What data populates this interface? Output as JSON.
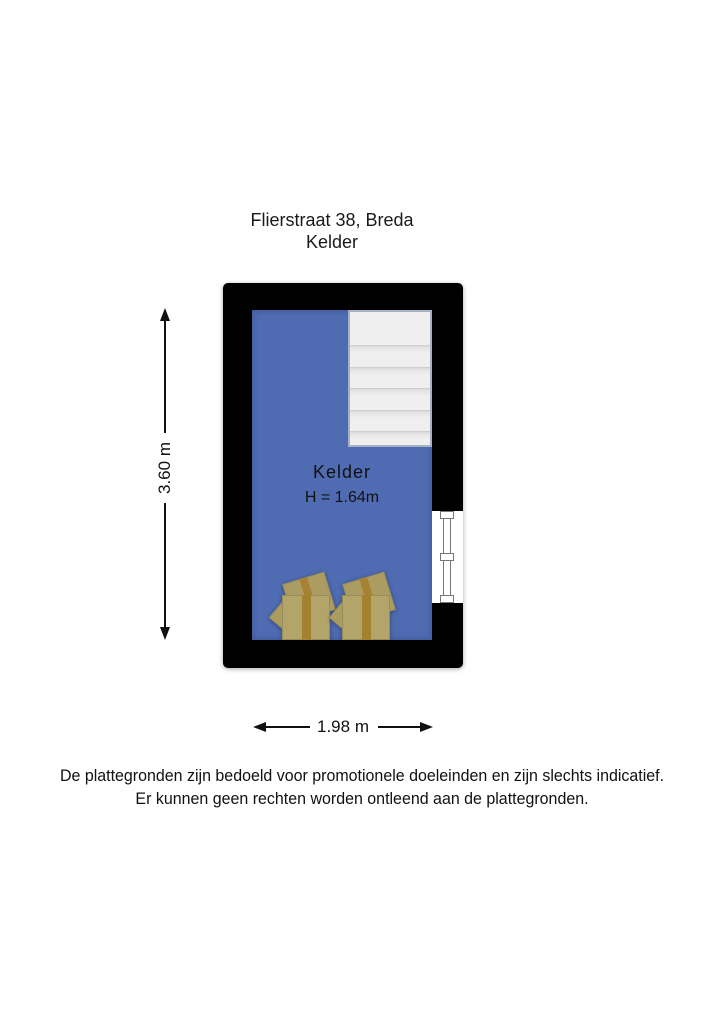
{
  "title": {
    "address": "Flierstraat 38, Breda",
    "floor": "Kelder"
  },
  "room": {
    "name": "Kelder",
    "height_label": "H = 1.64m"
  },
  "dimensions": {
    "height": "3.60 m",
    "width": "1.98 m"
  },
  "disclaimer": {
    "line1": "De plattegronden zijn bedoeld voor promotionele doeleinden en zijn slechts indicatief.",
    "line2": "Er kunnen geen rechten worden ontleend aan de plattegronden."
  },
  "plan": {
    "stair_tread_count": 6,
    "box_count": 2,
    "window_count": 1
  },
  "colors": {
    "floor": "#4f6bb2",
    "wall": "#000000",
    "stairs": "#efefef",
    "stair_border": "#a8b0c6",
    "box": "#b3a46a",
    "box_flap": "#ab9d62",
    "box_tape": "#a5812f",
    "window_frame": "#777777",
    "dimension": "#111111",
    "text": "#1a1a1a"
  }
}
